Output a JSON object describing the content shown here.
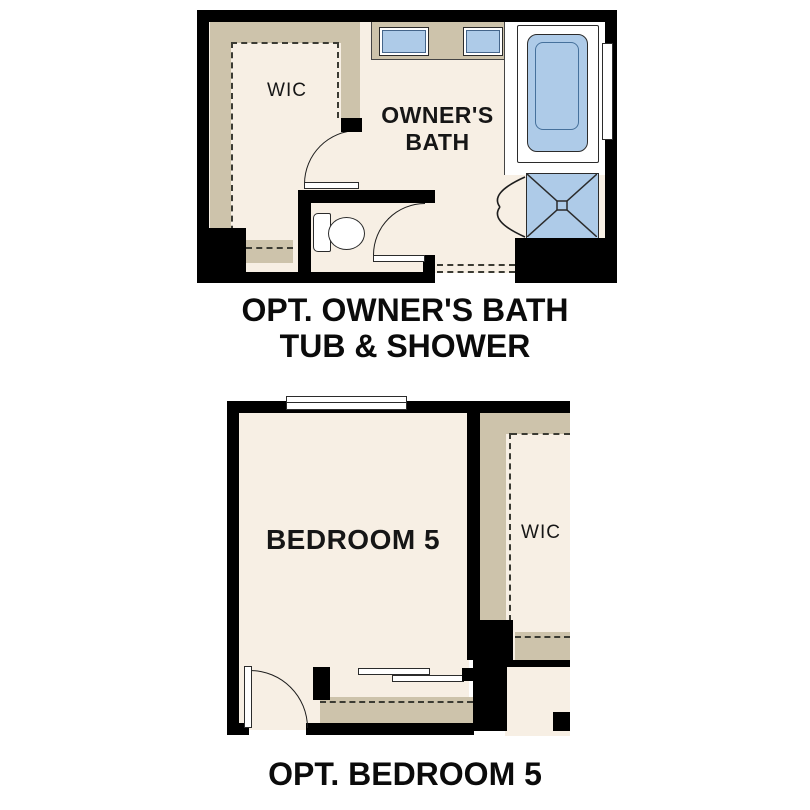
{
  "colors": {
    "background": "#ffffff",
    "walls": "#000000",
    "floor": "#f7efe4",
    "shelving": "#cdc3ab",
    "fixture_blue": "#aecbe8",
    "line": "#2b2b2b",
    "text": "#111111"
  },
  "top_plan": {
    "caption_line1": "OPT. OWNER'S BATH",
    "caption_line2": "TUB & SHOWER",
    "rooms": {
      "wic": "WIC",
      "bath": "OWNER'S BATH"
    },
    "fixtures": [
      "vanity-sink-left",
      "vanity-sink-right",
      "bathtub",
      "shower-pan",
      "shower-door",
      "toilet",
      "window",
      "wic-door",
      "wc-door",
      "shelving",
      "entry-dashed-opening"
    ]
  },
  "bottom_plan": {
    "caption": "OPT. BEDROOM 5",
    "rooms": {
      "bedroom": "BEDROOM 5",
      "wic": "WIC"
    },
    "fixtures": [
      "window",
      "entry-door",
      "closet-shelf-rod",
      "wic-shelving"
    ]
  }
}
